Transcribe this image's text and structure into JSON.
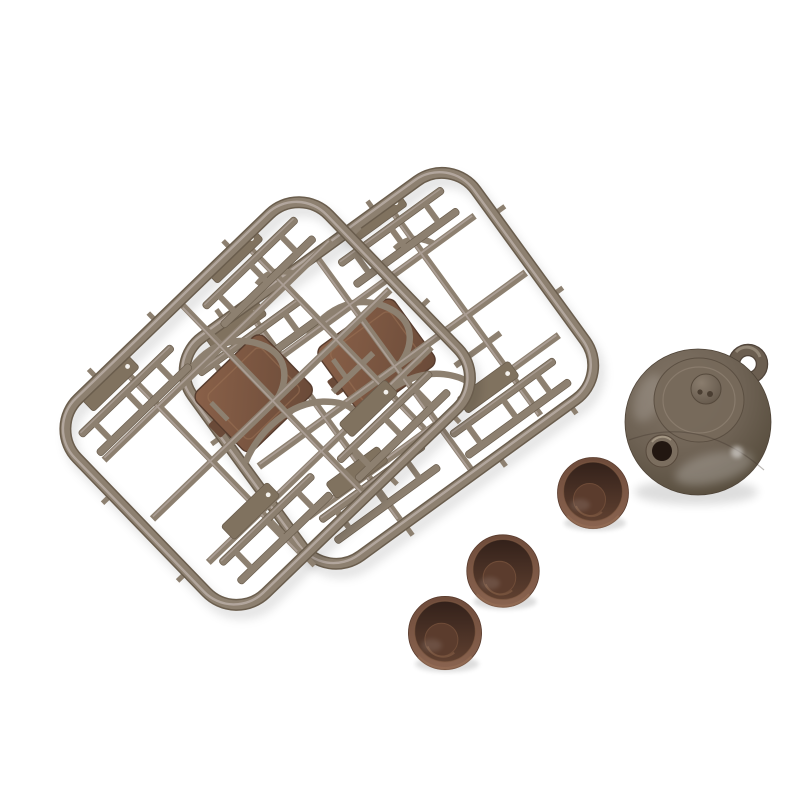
{
  "image": {
    "type": "product-photo",
    "background_color": "#ffffff",
    "subject": "Miniature plastic tea-set model kit: two sprue part frames with miniature table and chair parts, one miniature teapot, three miniature tea cups",
    "objects": [
      {
        "name": "sprue-frame-back",
        "description": "rounded-rectangle plastic runner frame (back), tilted, holding flat-molded miniature furniture parts"
      },
      {
        "name": "sprue-frame-front",
        "description": "rounded-rectangle plastic runner frame (front), tilted, overlapping the back frame"
      },
      {
        "name": "table-top-part",
        "description": "reddish-brown square miniature table top molded inside each frame"
      },
      {
        "name": "chair-part",
        "description": "ladder-like miniature chair parts molded along the runners"
      },
      {
        "name": "teapot",
        "description": "glossy olive-brown miniature teapot seen from above with ring handle, lid knob and open spout"
      },
      {
        "name": "tea-cup-1",
        "description": "small brown tea cup, upper of the three"
      },
      {
        "name": "tea-cup-2",
        "description": "small brown tea cup, middle of the three"
      },
      {
        "name": "tea-cup-3",
        "description": "small brown tea cup, lowest of the three"
      }
    ],
    "colors": {
      "background": "#ffffff",
      "sprue_plastic": "#8d8070",
      "sprue_highlight": "#bcafa9",
      "sprue_shadow": "#6a5d4d",
      "part_slab": "#80725f",
      "part_slab_dark": "#6f6052",
      "plate_light": "#8a6149",
      "plate_dark": "#6a4a38",
      "plate_edge": "#563c2e",
      "pot_light": "#837668",
      "pot_mid": "#6e6254",
      "pot_dark": "#534939",
      "pot_lid": "#776a5b",
      "pot_hole": "#221711",
      "pot_handle": "#6b5e50",
      "cup_rim": "#6e4b3a",
      "cup_light": "#8a6450",
      "cup_cavity_dark": "#33211a",
      "cup_cavity_light": "#5f4030",
      "cup_bottom": "#5b3c2d",
      "contact_shadow": "#000000"
    }
  }
}
